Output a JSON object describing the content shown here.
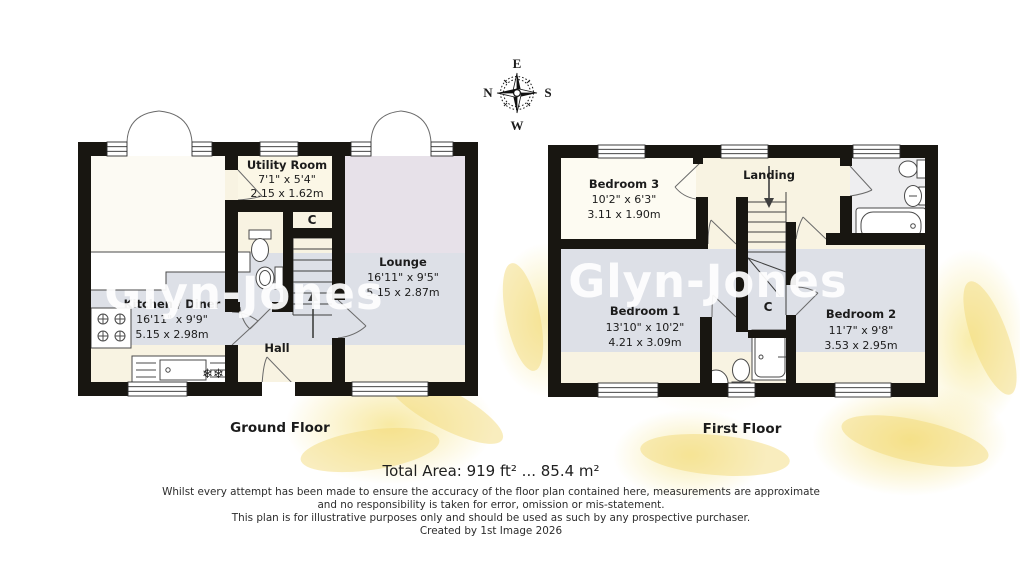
{
  "compass": {
    "north": "N",
    "east": "E",
    "south": "S",
    "west": "W"
  },
  "watermark": "Glyn-Jones",
  "ground_floor": {
    "floor_label": "Ground Floor",
    "rooms": {
      "utility": {
        "name": "Utility Room",
        "dims_imperial": "7'1\" x 5'4\"",
        "dims_metric": "2.15 x 1.62m"
      },
      "lounge": {
        "name": "Lounge",
        "dims_imperial": "16'11\" x 9'5\"",
        "dims_metric": "5.15 x 2.87m"
      },
      "kitchen": {
        "name": "Kitchen / Diner",
        "dims_imperial": "16'11\" x 9'9\"",
        "dims_metric": "5.15 x 2.98m"
      },
      "hall": {
        "name": "Hall"
      },
      "cupboard": {
        "name": "C"
      }
    },
    "freezer_icon": "❄❄"
  },
  "first_floor": {
    "floor_label": "First Floor",
    "rooms": {
      "bedroom3": {
        "name": "Bedroom 3",
        "dims_imperial": "10'2\" x 6'3\"",
        "dims_metric": "3.11 x 1.90m"
      },
      "landing": {
        "name": "Landing"
      },
      "bedroom1": {
        "name": "Bedroom 1",
        "dims_imperial": "13'10\" x 10'2\"",
        "dims_metric": "4.21 x 3.09m"
      },
      "bedroom2": {
        "name": "Bedroom 2",
        "dims_imperial": "11'7\" x 9'8\"",
        "dims_metric": "3.53 x 2.95m"
      },
      "cupboard": {
        "name": "C"
      }
    }
  },
  "footer": {
    "total_area": "Total Area: 919 ft² ... 85.4 m²",
    "disclaimer_line1": "Whilst every attempt has been made to ensure the accuracy of the floor plan contained here, measurements are approximate",
    "disclaimer_line2": "and no responsibility is taken for error, omission or mis-statement.",
    "disclaimer_line3": "This plan is for illustrative purposes only and should be used as such by any prospective purchaser.",
    "disclaimer_line4": "Created by 1st Image 2026"
  },
  "colors": {
    "wall": "#181611",
    "band": "#d8dce8",
    "cream": "#f8f3e2"
  }
}
